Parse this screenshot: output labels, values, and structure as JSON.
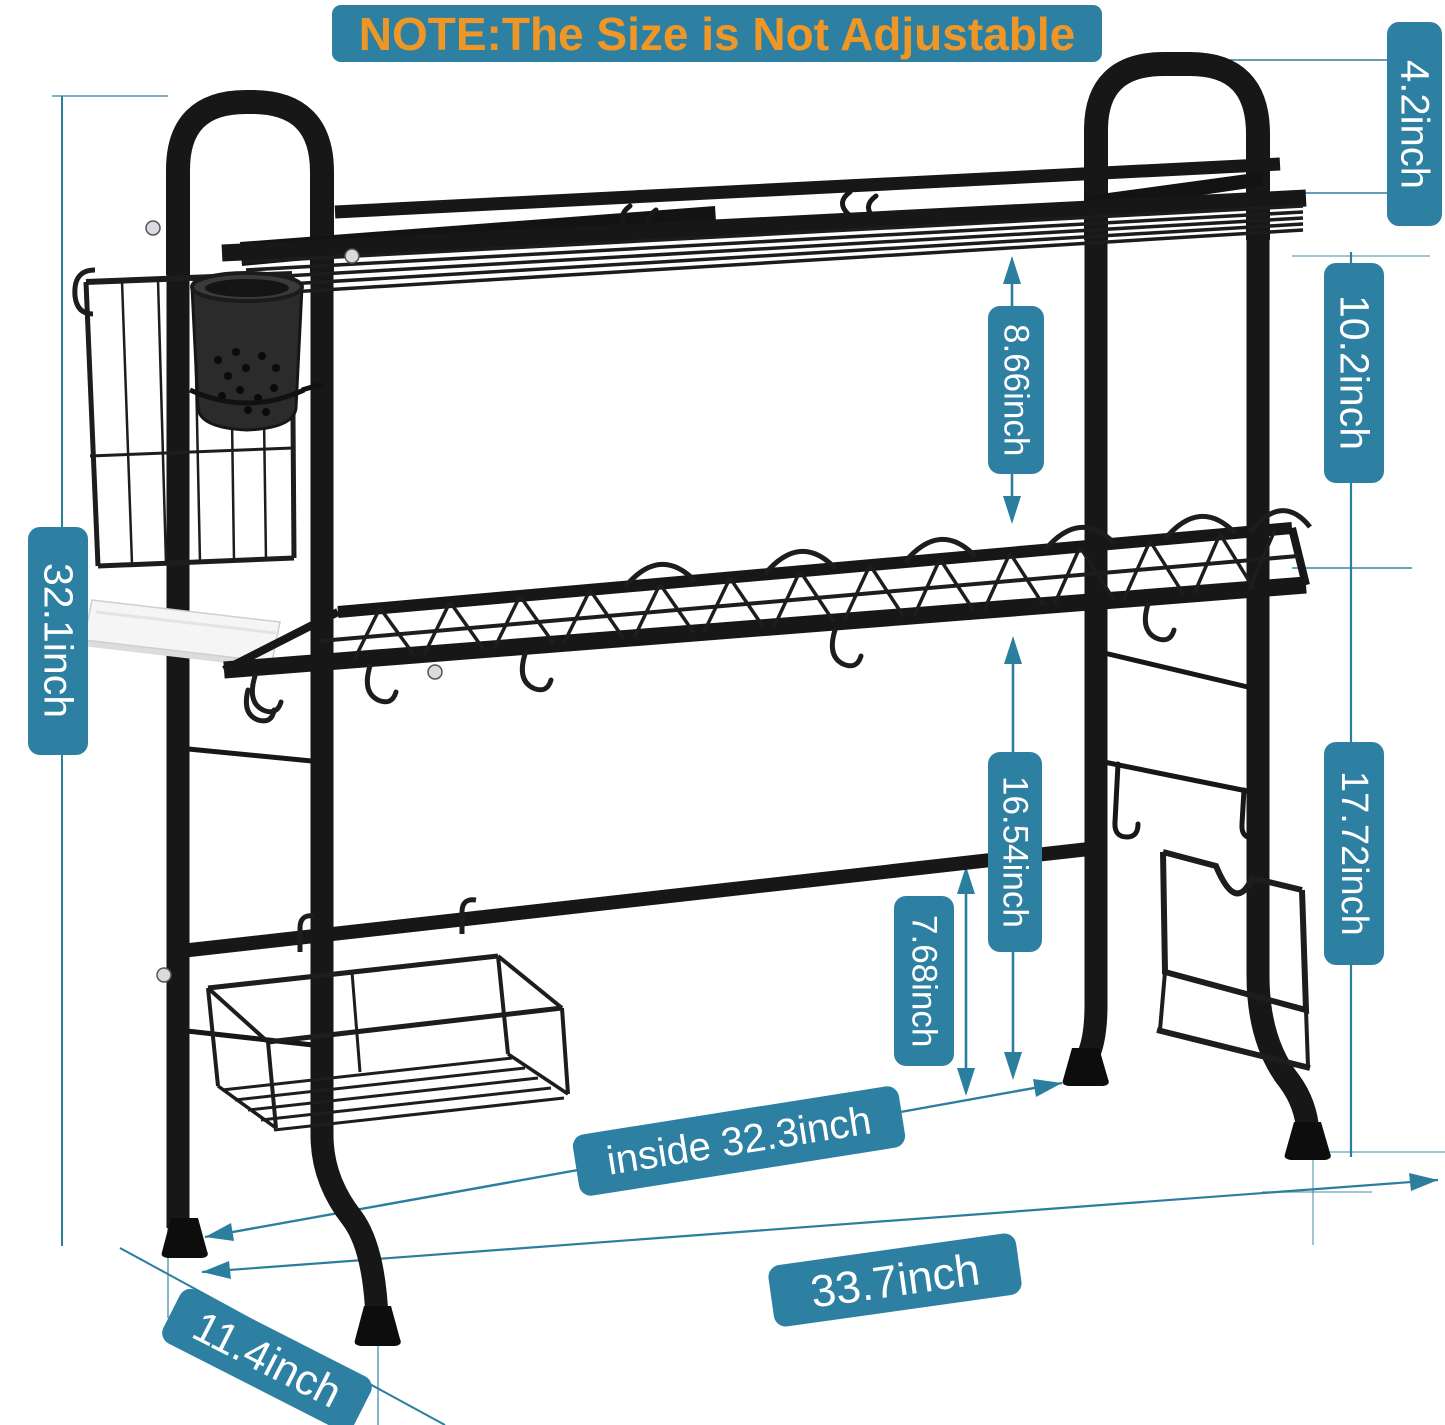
{
  "note": {
    "text": "NOTE:The Size is Not Adjustable"
  },
  "colors": {
    "label_background": "#2e80a3",
    "label_text": "#ffffff",
    "note_text": "#ef9726",
    "dimension_line": "#2b7e9e",
    "rack_black": "#171717"
  },
  "dimensions": {
    "handle_height": "4.2inch",
    "shelf_to_top": "10.2inch",
    "tier_gap": "8.66inch",
    "total_height": "32.1inch",
    "under_shelf_clearance": "16.54inch",
    "bar_to_counter": "7.68inch",
    "side_clearance": "17.72inch",
    "inside_width": "inside 32.3inch",
    "overall_width": "33.7inch",
    "depth": "11.4inch"
  }
}
